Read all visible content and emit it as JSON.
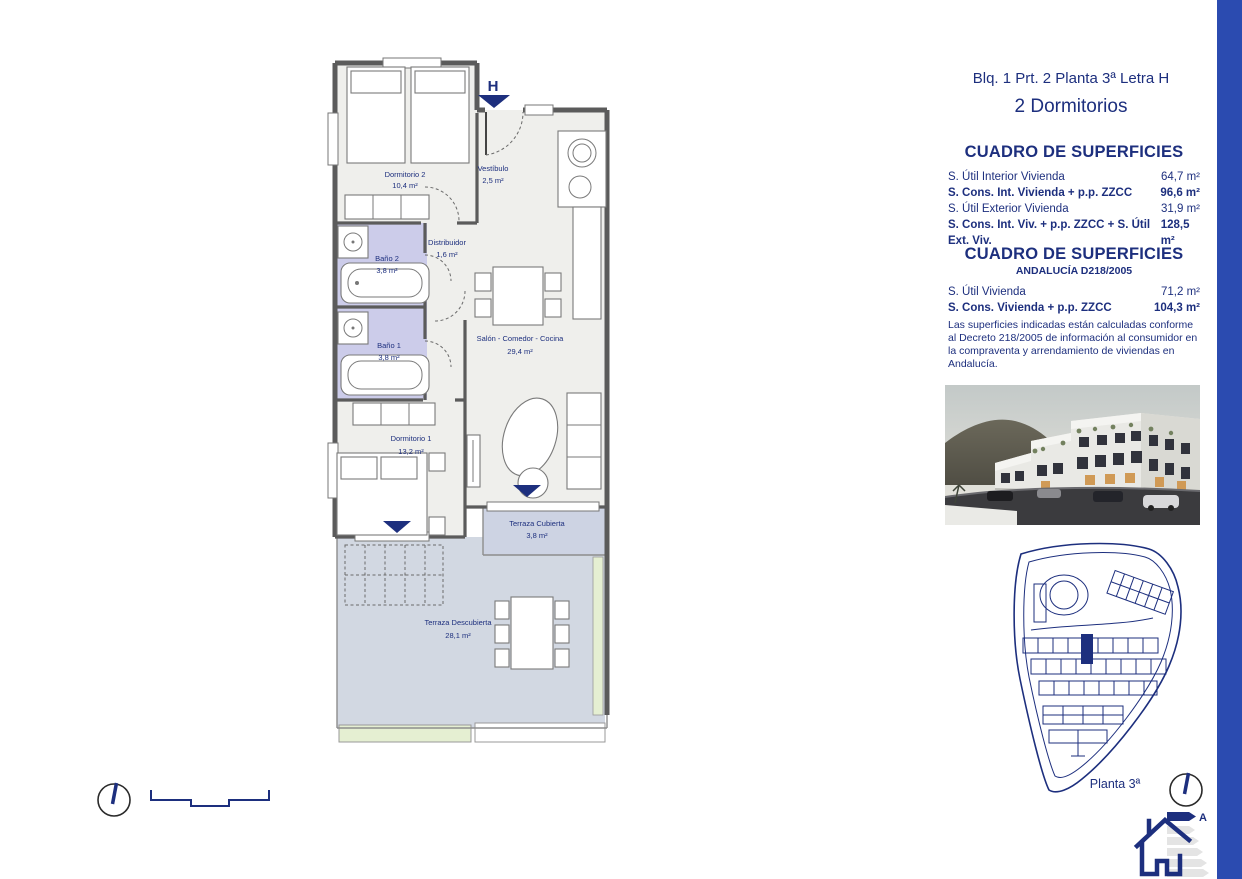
{
  "page": {
    "accent_blue": "#2b4bb0",
    "navy_text": "#1d2f7e",
    "wall_gray": "#5b5b5b",
    "bath_fill": "#ccccea",
    "terrace_fill": "#d2d8e2",
    "planter_green": "#e5efd2"
  },
  "header": {
    "title_line1": "Blq. 1 Prt. 2 Planta 3ª Letra H",
    "title_line2": "2 Dormitorios"
  },
  "surfaces_table_1": {
    "title": "CUADRO DE SUPERFICIES",
    "rows": [
      {
        "label": "S. Útil Interior Vivienda",
        "value": "64,7 m²"
      },
      {
        "label": "S. Cons. Int. Vivienda + p.p. ZZCC",
        "value": "96,6 m²"
      },
      {
        "label": "S. Útil Exterior Vivienda",
        "value": "31,9 m²"
      },
      {
        "label": "S. Cons. Int. Viv. + p.p. ZZCC + S. Útil Ext. Viv.",
        "value": "128,5 m²"
      }
    ]
  },
  "surfaces_table_2": {
    "title": "CUADRO DE SUPERFICIES",
    "subtitle": "ANDALUCÍA D218/2005",
    "rows": [
      {
        "label": "S. Útil Vivienda",
        "value": "71,2 m²"
      },
      {
        "label": "S. Cons. Vivienda + p.p. ZZCC",
        "value": "104,3 m²"
      }
    ],
    "note": "Las superficies indicadas están calculadas conforme al Decreto 218/2005 de información al consumidor en la compraventa y arrendamiento de viviendas en Andalucía."
  },
  "floorplan": {
    "entrance_label": "H",
    "rooms": {
      "dormitorio2": {
        "name": "Dormitorio 2",
        "area": "10,4 m²"
      },
      "vestibulo": {
        "name": "Vestíbulo",
        "area": "2,5 m²"
      },
      "distribuidor": {
        "name": "Distribuidor",
        "area": "1,6 m²"
      },
      "bano2": {
        "name": "Baño 2",
        "area": "3,8 m²"
      },
      "bano1": {
        "name": "Baño 1",
        "area": "3,8 m²"
      },
      "salon": {
        "name": "Salón - Comedor - Cocina",
        "area": "29,4 m²"
      },
      "dormitorio1": {
        "name": "Dormitorio 1",
        "area": "13,2 m²"
      },
      "terraza_cubierta": {
        "name": "Terraza Cubierta",
        "area": "3,8 m²"
      },
      "terraza_descubierta": {
        "name": "Terraza Descubierta",
        "area": "28,1 m²"
      }
    }
  },
  "siteplan": {
    "floor_label": "Planta 3ª"
  },
  "energy_icon": {
    "rating": "A"
  }
}
